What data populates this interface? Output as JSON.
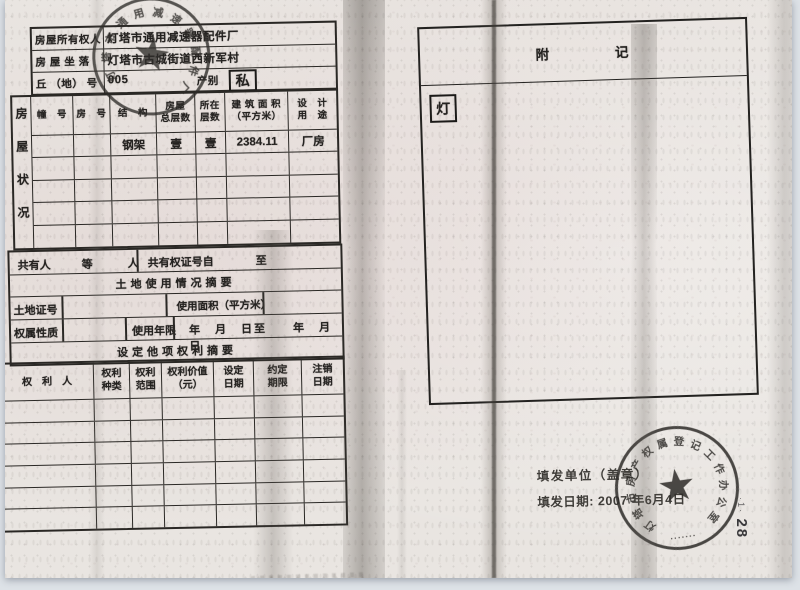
{
  "form": {
    "owner": {
      "label": "房屋所有权人",
      "value": "灯塔市通用减速器配件厂"
    },
    "location": {
      "label": "房 屋 坐 落",
      "value": "灯塔市古城街道西新军村"
    },
    "plot": {
      "label": "丘 （地） 号",
      "value": "005",
      "category_label": "产别",
      "category_value": "私"
    },
    "status": {
      "side_label": "房屋状况",
      "headers": [
        {
          "l1": "幢　号",
          "l2": ""
        },
        {
          "l1": "房　号",
          "l2": ""
        },
        {
          "l1": "结　构",
          "l2": ""
        },
        {
          "l1": "房屋",
          "l2": "总层数"
        },
        {
          "l1": "所在",
          "l2": "层数"
        },
        {
          "l1": "建 筑 面 积",
          "l2": "（平方米）"
        },
        {
          "l1": "设　计",
          "l2": "用　途"
        }
      ],
      "row1": {
        "structure": "钢架",
        "total_floors": "壹",
        "floor_no": "壹",
        "area": "2384.11",
        "designed_use": "厂房"
      }
    },
    "co_owner": {
      "label": "共有人",
      "suffix": "等　人",
      "cert_from": "共有权证号自",
      "cert_to": "至"
    },
    "land_title": "土地使用情况摘要",
    "land": {
      "cert_label": "土地证号",
      "area_label": "使用面积（平方米）"
    },
    "tenure": {
      "label": "权属性质",
      "term_label": "使用年限",
      "term_dates": "年　月　日至　　年　月　日"
    },
    "rights_title": "设定他项权利摘要",
    "rights": {
      "headers": [
        {
          "l1": "权　利　人",
          "l2": ""
        },
        {
          "l1": "权利",
          "l2": "种类"
        },
        {
          "l1": "权利",
          "l2": "范围"
        },
        {
          "l1": "权利价值",
          "l2": "（元）"
        },
        {
          "l1": "设定",
          "l2": "日期"
        },
        {
          "l1": "约定",
          "l2": "期限"
        },
        {
          "l1": "注销",
          "l2": "日期"
        }
      ]
    }
  },
  "annex": {
    "title_left": "附",
    "title_right": "记",
    "note": "灯"
  },
  "issue": {
    "unit_label": "填发单位（盖章）",
    "date_label": "填发日期: 2007 年6月4日"
  },
  "stamps": {
    "factory_seal": {
      "text": "灯塔市通用减速器配件厂",
      "chars": [
        "灯",
        "塔",
        "市",
        "通",
        "用",
        "减",
        "速",
        "器",
        "配",
        "件",
        "厂"
      ]
    },
    "office_seal": {
      "text": "灯塔市房产权属登记工作办公室",
      "chars": [
        "灯",
        "塔",
        "市",
        "房",
        "产",
        "权",
        "属",
        "登",
        "记",
        "工",
        "作",
        "办",
        "公",
        "室"
      ],
      "bottom_marks": "▪▪▪▪▪▪▪"
    }
  },
  "margin": {
    "mark": "·1·",
    "page_number": "28"
  }
}
